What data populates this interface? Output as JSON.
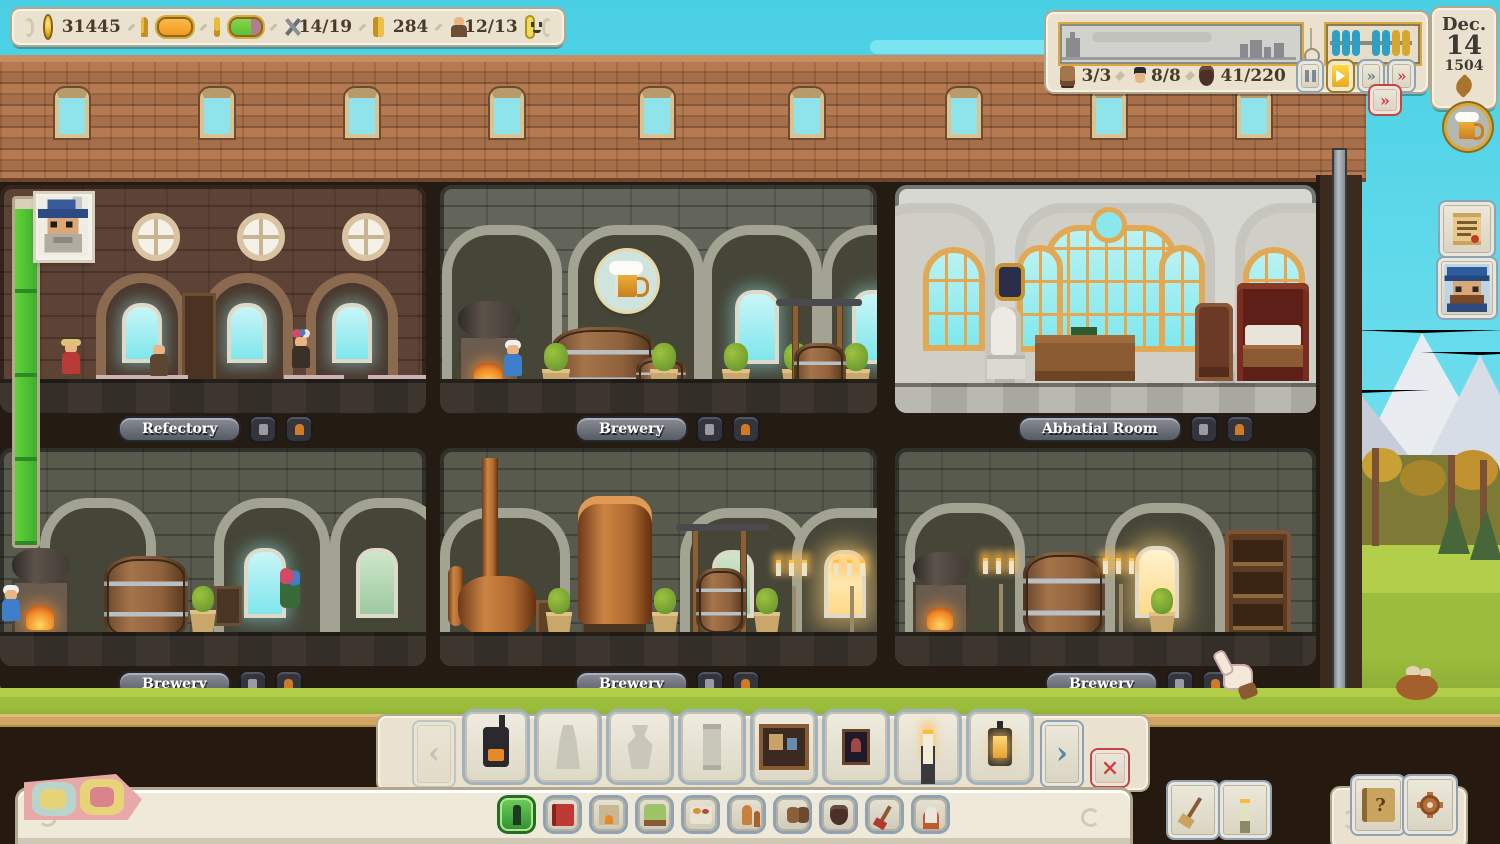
{
  "topbar": {
    "coins": "31445",
    "tools": "14/19",
    "recipes": "284",
    "monks": "12/13",
    "satisfaction_fill_pct": 100,
    "quality_fill_pct": 68
  },
  "status_panel": {
    "carts": "3/3",
    "workers": "8/8",
    "storage": "41/220",
    "speed_state": "play",
    "abacus": {
      "blue_beads": 5,
      "yellow_beads": 2
    }
  },
  "date": {
    "month": "Dec.",
    "day": "14",
    "year": "1504"
  },
  "rooms": {
    "top": [
      "Refectory",
      "Brewery",
      "Abbatial Room"
    ],
    "bottom": [
      "Brewery",
      "Brewery",
      "Brewery"
    ]
  },
  "visitor_meter": {
    "fill_pct": 97
  },
  "build_menu": {
    "items": [
      "iron-stove",
      "statue-blueprint",
      "fountain-blueprint",
      "column-blueprint",
      "framed-painting",
      "icon-painting",
      "candle",
      "lantern"
    ],
    "locked_indices": [
      1,
      2,
      3
    ]
  },
  "category_bar": {
    "items": [
      "decor-bottle",
      "book",
      "fireplace",
      "bed",
      "food-table",
      "copper-still",
      "barrels",
      "sack",
      "broom",
      "statue"
    ],
    "selected_index": 0
  },
  "ui": {
    "close_glyph": "×",
    "help_glyph": "?",
    "fast_glyph": "»",
    "prev_glyph": "‹",
    "next_glyph": "›"
  },
  "colors": {
    "sky": "#5fd9ea",
    "roof": "#a76f49",
    "parchment": "#eae2cf",
    "gold_accent": "#d9a93b",
    "green_fill": "#57c337",
    "orange_fill": "#ef9c22",
    "quality_rest": "#b27e8e",
    "abacus_blue": "#2f9fc4",
    "abacus_yellow": "#d7a62e",
    "alert_red": "#d04040",
    "selected_green": "#3f9a3a"
  }
}
